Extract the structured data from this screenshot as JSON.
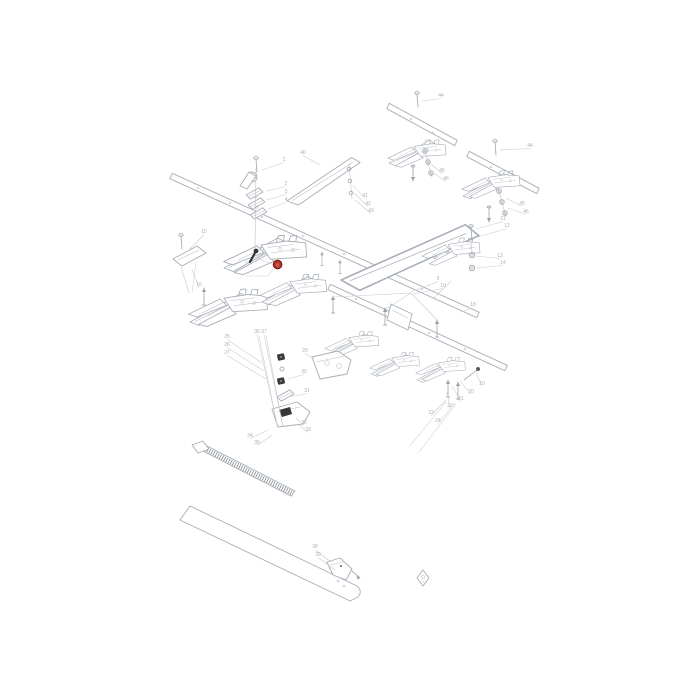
{
  "diagram": {
    "type": "exploded-parts-diagram",
    "subject": "cutter bar / knife guard assembly",
    "background_color": "#ffffff",
    "line_color": "#a8aeb6",
    "dark_part_color": "#383838",
    "callout_color": "#aab0b8",
    "highlight": {
      "label": "8",
      "fill": "#b5372c",
      "ring": "#7c1710"
    },
    "callouts": [
      {
        "label": "1",
        "x": 284,
        "y": 161,
        "tx": 262,
        "ty": 170
      },
      {
        "label": "2",
        "x": 286,
        "y": 185,
        "tx": 266,
        "ty": 191
      },
      {
        "label": "3",
        "x": 286,
        "y": 193,
        "tx": 267,
        "ty": 200
      },
      {
        "label": "4",
        "x": 286,
        "y": 201,
        "tx": 268,
        "ty": 209
      },
      {
        "label": "40",
        "x": 303,
        "y": 154,
        "tx": 320,
        "ty": 165
      },
      {
        "label": "41",
        "x": 365,
        "y": 197,
        "tx": 353,
        "ty": 185
      },
      {
        "label": "42",
        "x": 368,
        "y": 205,
        "tx": 354,
        "ty": 193
      },
      {
        "label": "43",
        "x": 371,
        "y": 212,
        "tx": 355,
        "ty": 200
      },
      {
        "label": "44",
        "x": 441,
        "y": 97,
        "tx": 422,
        "ty": 101
      },
      {
        "label": "45",
        "x": 442,
        "y": 172,
        "tx": 431,
        "ty": 164
      },
      {
        "label": "46",
        "x": 446,
        "y": 180,
        "tx": 433,
        "ty": 173
      },
      {
        "label": "44",
        "x": 530,
        "y": 147,
        "tx": 500,
        "ty": 150
      },
      {
        "label": "45",
        "x": 522,
        "y": 205,
        "tx": 506,
        "ty": 198
      },
      {
        "label": "46",
        "x": 526,
        "y": 213,
        "tx": 508,
        "ty": 208
      },
      {
        "label": "11",
        "x": 503,
        "y": 220,
        "tx": 476,
        "ty": 229
      },
      {
        "label": "12",
        "x": 507,
        "y": 227,
        "tx": 478,
        "ty": 237
      },
      {
        "label": "13",
        "x": 500,
        "y": 257,
        "tx": 476,
        "ty": 256
      },
      {
        "label": "14",
        "x": 503,
        "y": 264,
        "tx": 477,
        "ty": 268
      },
      {
        "label": "15",
        "x": 204,
        "y": 233,
        "tx": 189,
        "ty": 250
      },
      {
        "label": "16",
        "x": 199,
        "y": 286,
        "tx": 192,
        "ty": 270
      },
      {
        "label": "9",
        "x": 438,
        "y": 280,
        "tx": 411,
        "ty": 292
      },
      {
        "label": "10",
        "x": 443,
        "y": 287,
        "tx": 413,
        "ty": 294
      },
      {
        "label": "18",
        "x": 473,
        "y": 306,
        "tx": 462,
        "ty": 312
      },
      {
        "label": "19",
        "x": 482,
        "y": 385,
        "tx": 476,
        "ty": 373
      },
      {
        "label": "20",
        "x": 471,
        "y": 393,
        "tx": 460,
        "ty": 381
      },
      {
        "label": "21",
        "x": 461,
        "y": 400,
        "tx": 452,
        "ty": 386
      },
      {
        "label": "22",
        "x": 450,
        "y": 407,
        "tx": 447,
        "ty": 392
      },
      {
        "label": "23",
        "x": 431,
        "y": 414,
        "tx": 446,
        "ty": 400
      },
      {
        "label": "24",
        "x": 438,
        "y": 422,
        "tx": 455,
        "ty": 403
      },
      {
        "label": "25",
        "x": 227,
        "y": 338,
        "tx": 262,
        "ty": 363
      },
      {
        "label": "26",
        "x": 227,
        "y": 346,
        "tx": 264,
        "ty": 371
      },
      {
        "label": "27",
        "x": 227,
        "y": 354,
        "tx": 266,
        "ty": 379
      },
      {
        "label": "36",
        "x": 257,
        "y": 333,
        "tx": 277,
        "ty": 424
      },
      {
        "label": "37",
        "x": 264,
        "y": 333,
        "tx": 283,
        "ty": 427
      },
      {
        "label": "29",
        "x": 305,
        "y": 352,
        "tx": 314,
        "ty": 359
      },
      {
        "label": "30",
        "x": 304,
        "y": 373,
        "tx": 288,
        "ty": 379
      },
      {
        "label": "31",
        "x": 307,
        "y": 392,
        "tx": 288,
        "ty": 397
      },
      {
        "label": "32",
        "x": 304,
        "y": 424,
        "tx": 296,
        "ty": 418
      },
      {
        "label": "33",
        "x": 308,
        "y": 431,
        "tx": 298,
        "ty": 424
      },
      {
        "label": "34",
        "x": 250,
        "y": 437,
        "tx": 268,
        "ty": 430
      },
      {
        "label": "35",
        "x": 257,
        "y": 444,
        "tx": 272,
        "ty": 435
      },
      {
        "label": "38",
        "x": 315,
        "y": 548,
        "tx": 331,
        "ty": 562
      },
      {
        "label": "39",
        "x": 318,
        "y": 556,
        "tx": 335,
        "ty": 570
      }
    ]
  }
}
